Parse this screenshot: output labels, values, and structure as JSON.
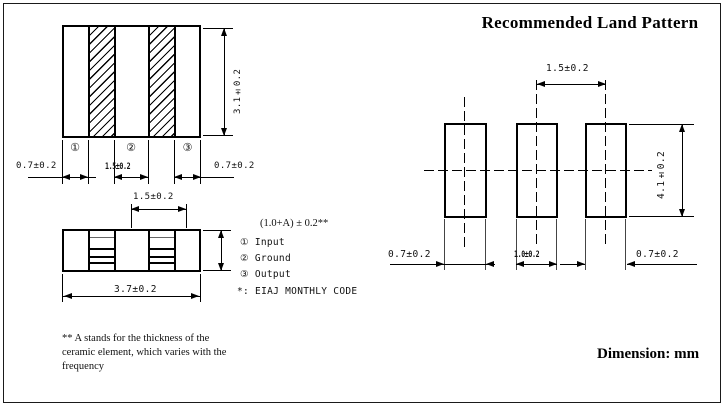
{
  "colors": {
    "ink": "#000000",
    "background": "#ffffff"
  },
  "component_views": {
    "top_view": {
      "dim_height": "3.1±0.2",
      "dim_left_terminal": "0.7±0.2",
      "dim_center_terminal": "1.5±0.2",
      "dim_right_terminal": "0.7±0.2",
      "terminals": {
        "t1": "①",
        "t2": "②",
        "t3": "③"
      }
    },
    "side_view": {
      "dim_terminal_pitch": "1.5±0.2",
      "dim_length": "3.7±0.2",
      "dim_thickness": "(1.0+A) ± 0.2**"
    }
  },
  "legend": {
    "items": [
      {
        "symbol": "①",
        "label": "Input"
      },
      {
        "symbol": "②",
        "label": "Ground"
      },
      {
        "symbol": "③",
        "label": "Output"
      }
    ],
    "note": "*: EIAJ MONTHLY CODE"
  },
  "footnote": {
    "line1": "** A stands for the thickness of the",
    "line2": "ceramic element, which varies with the",
    "line3": "frequency"
  },
  "land_pattern": {
    "title": "Recommended Land Pattern",
    "dim_pad_pitch": "1.5±0.2",
    "dim_pad_height": "4.1±0.2",
    "dim_left_pad_width": "0.7±0.2",
    "dim_center_pad_width": "1.0±0.2",
    "dim_right_pad_width": "0.7±0.2"
  },
  "footer": {
    "dimension_note": "Dimension: mm"
  }
}
